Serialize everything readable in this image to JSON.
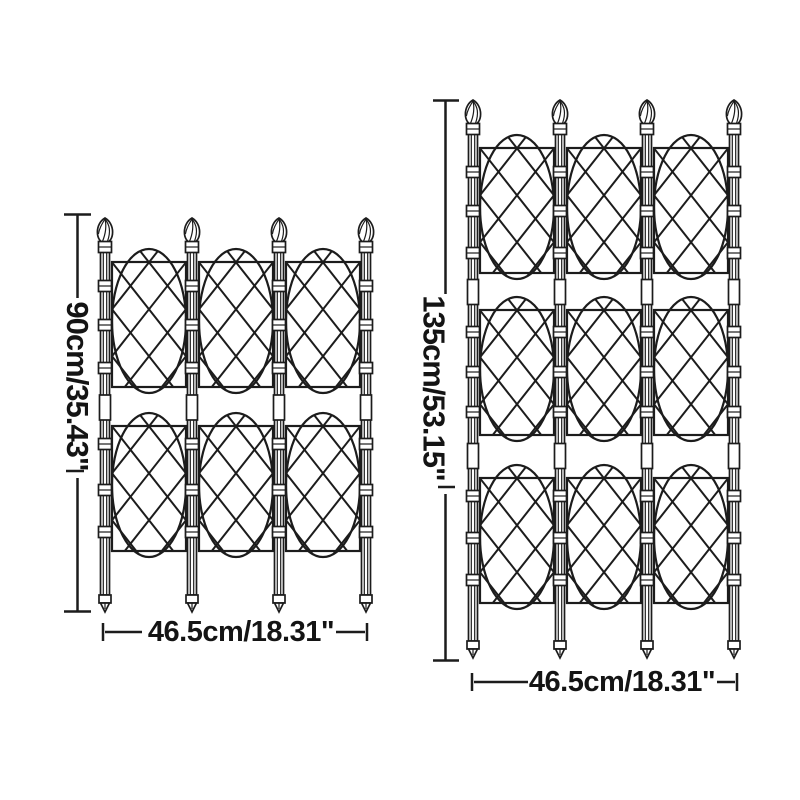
{
  "page": {
    "background": "#ffffff",
    "line_color": "#1c1c1c",
    "description_of_content": "dimension diagram of two garden obelisk trellis screens with lattice panels"
  },
  "trellis_small": {
    "height_label": "90cm/35.43\"",
    "width_label": "46.5cm/18.31\"",
    "poles": 4,
    "panel_rows": 2,
    "panel_columns": 3
  },
  "trellis_large": {
    "height_label": "135cm/53.15\"",
    "width_label": "46.5cm/18.31\"",
    "poles": 4,
    "panel_rows": 3,
    "panel_columns": 3
  }
}
